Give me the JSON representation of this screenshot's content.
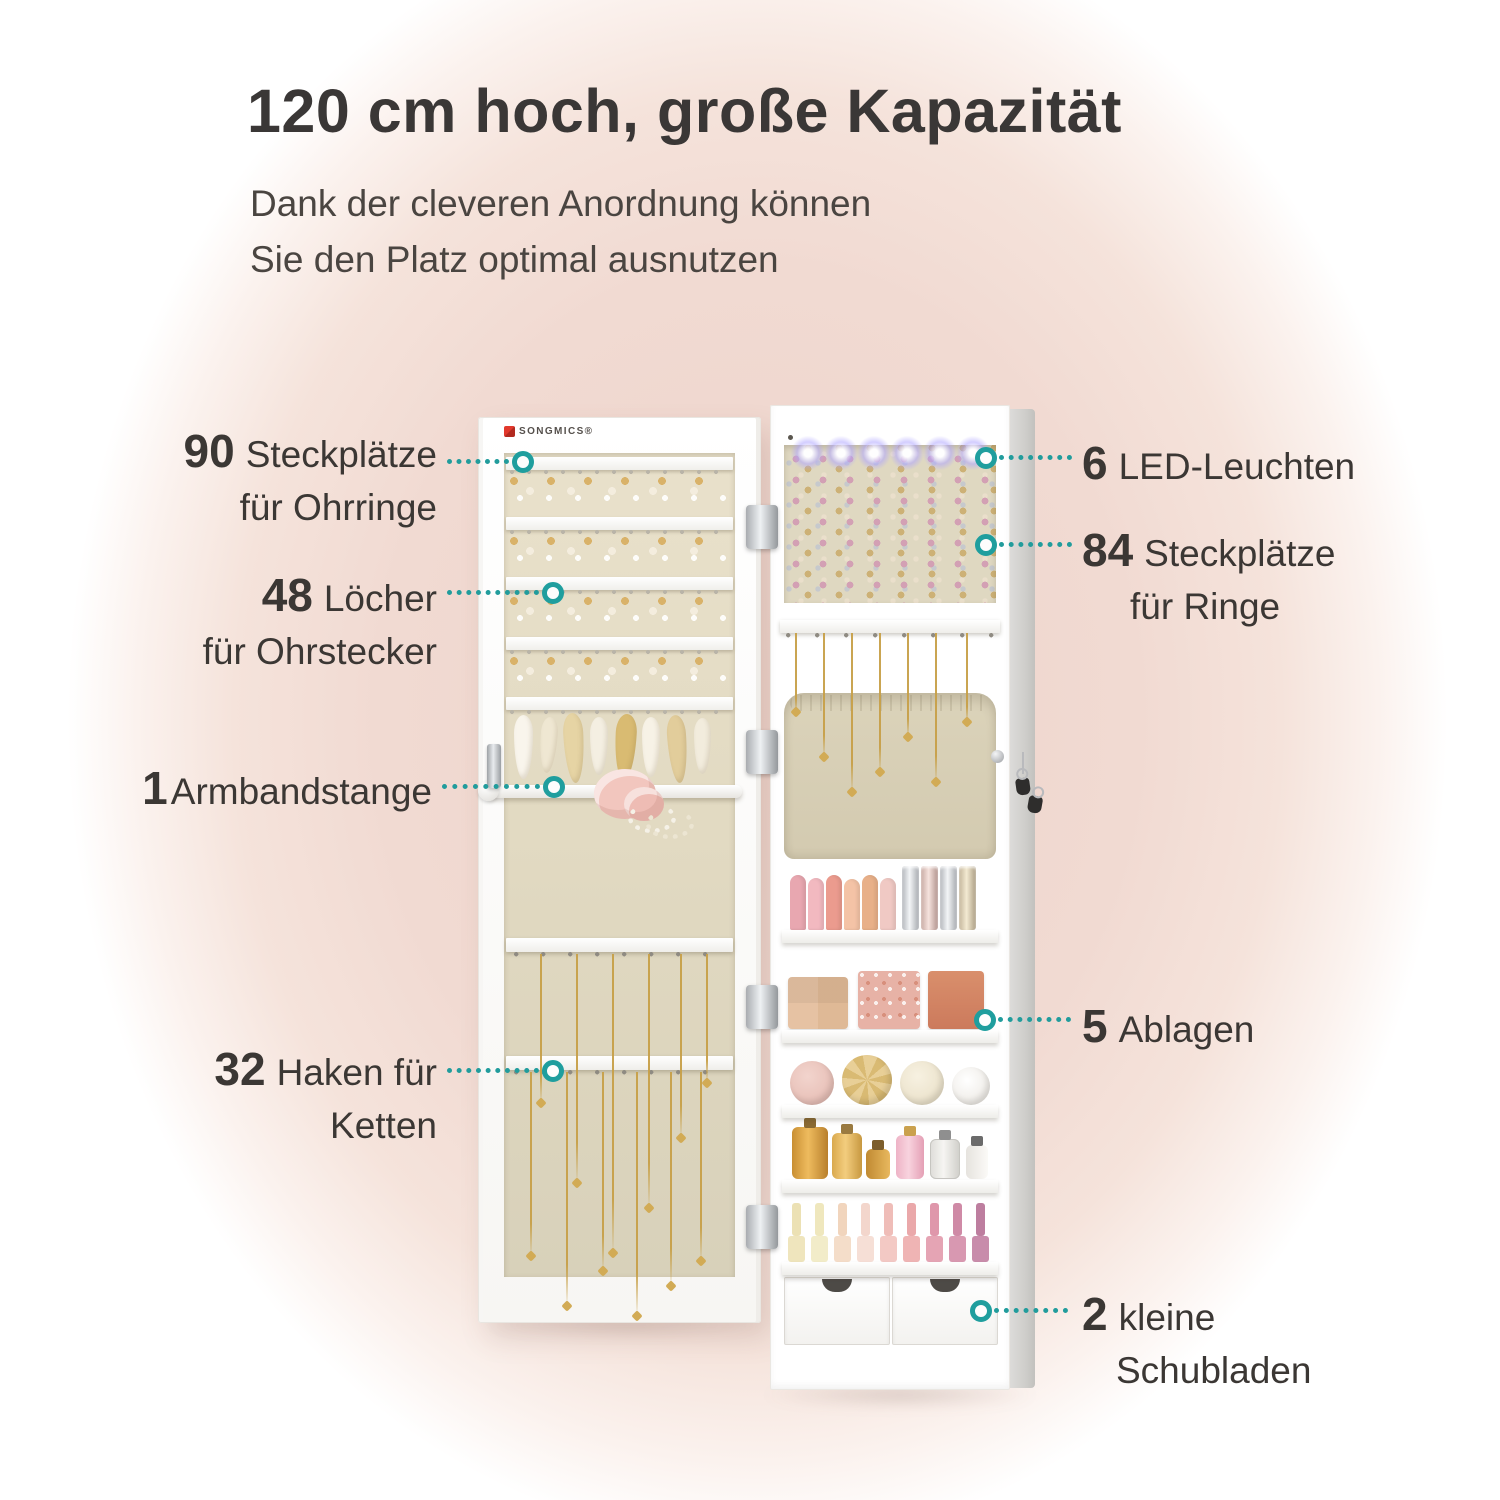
{
  "header": {
    "title": "120 cm hoch, große Kapazität",
    "subtitle_line1": "Dank der cleveren Anordnung können",
    "subtitle_line2": "Sie den Platz optimal ausnutzen"
  },
  "brand": {
    "logo_text": "SONGMICS®"
  },
  "callouts": {
    "left": [
      {
        "number": "90",
        "line1": "Steckplätze",
        "line2": "für Ohrringe"
      },
      {
        "number": "48",
        "line1": "Löcher",
        "line2": "für Ohrstecker"
      },
      {
        "number": "1",
        "line1": "Armbandstange",
        "line2": ""
      },
      {
        "number": "32",
        "line1": "Haken für",
        "line2": "Ketten"
      }
    ],
    "right": [
      {
        "number": "6",
        "line1": "LED-Leuchten",
        "line2": ""
      },
      {
        "number": "84",
        "line1": "Steckplätze",
        "line2": "für Ringe"
      },
      {
        "number": "5",
        "line1": "Ablagen",
        "line2": ""
      },
      {
        "number": "2",
        "line1": "kleine",
        "line2": "Schubladen"
      }
    ]
  },
  "colors": {
    "accent_teal": "#1F9E9E",
    "background_pink": "#EED4CB",
    "text_dark": "#3B3734"
  }
}
